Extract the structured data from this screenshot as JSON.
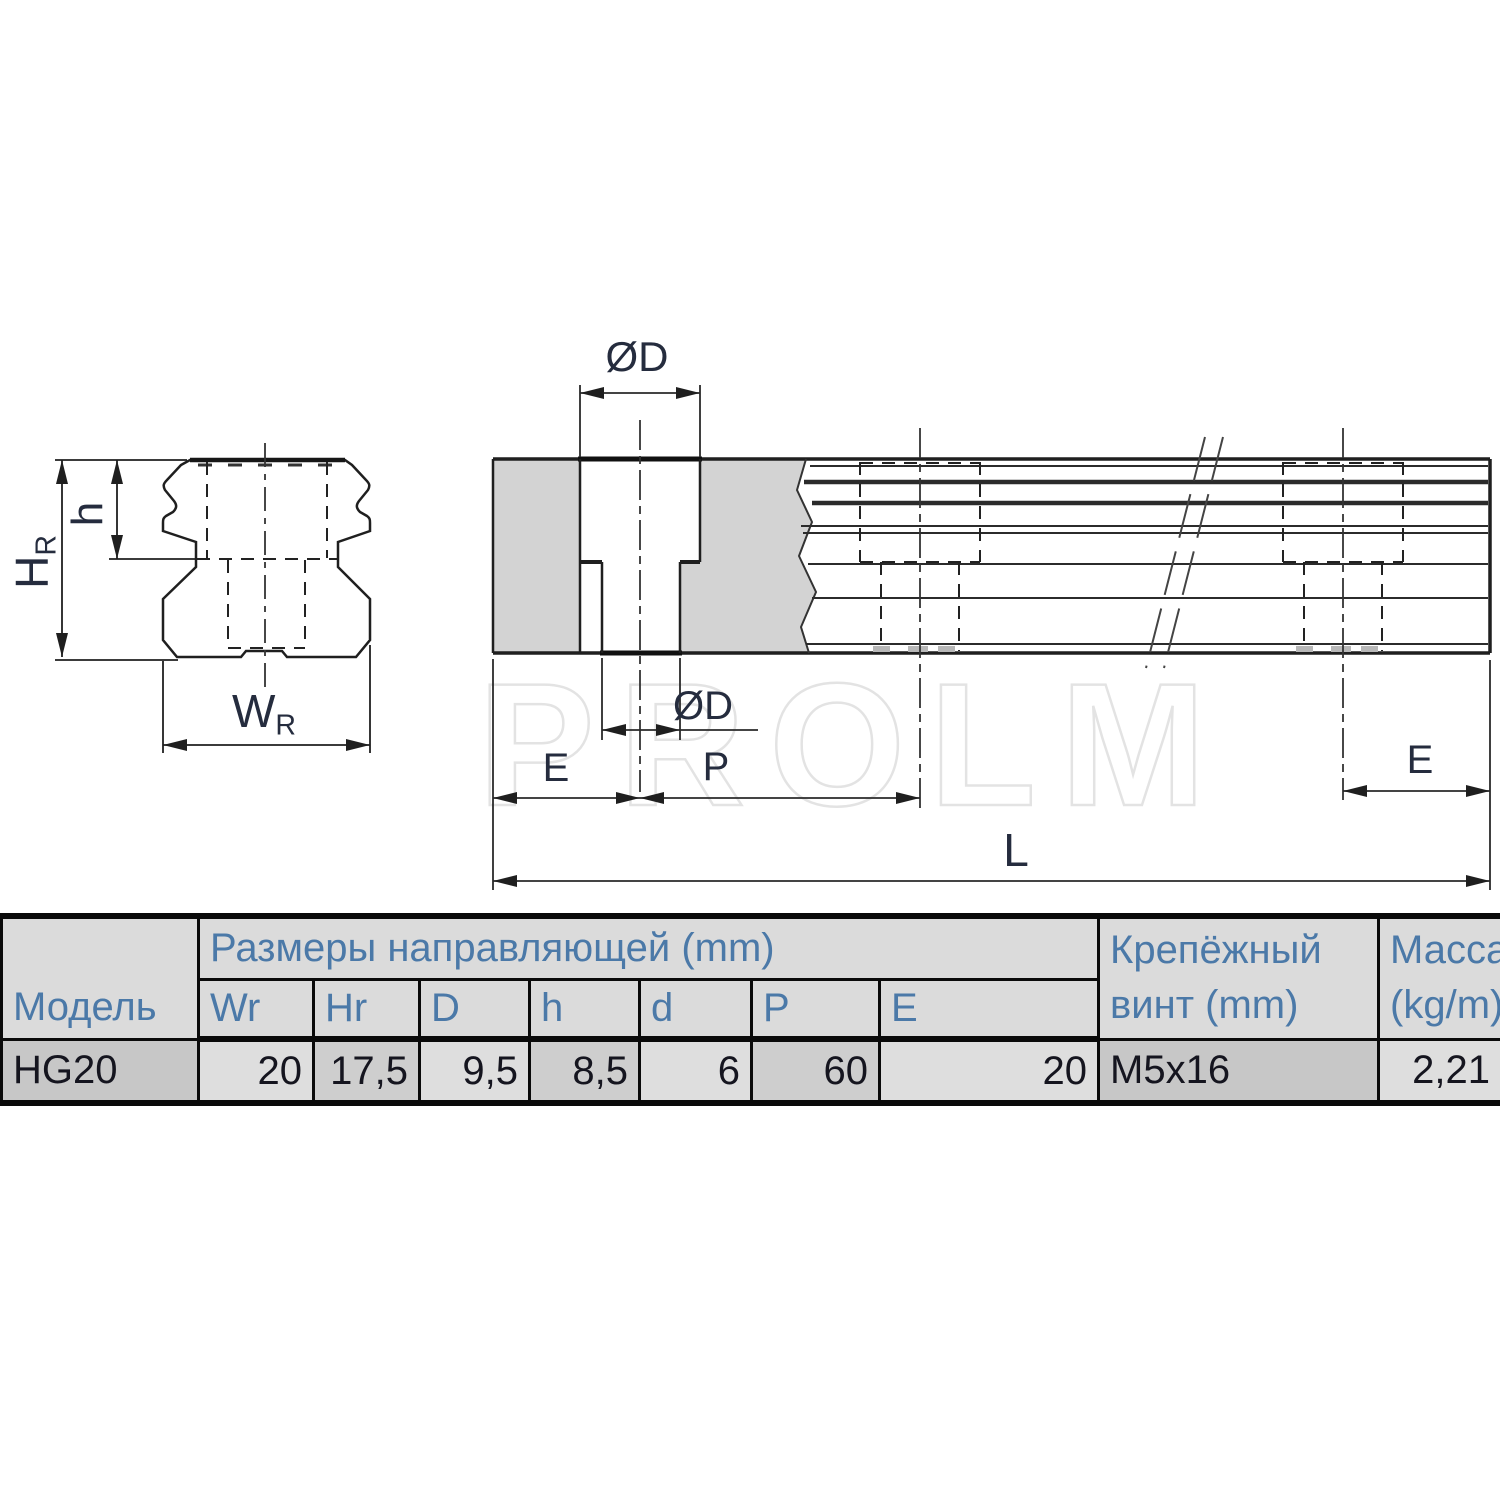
{
  "drawing": {
    "watermark": "PROLM",
    "labels": {
      "od_top": "ØD",
      "od_hole": "ØD",
      "e_left": "E",
      "pitch": "P",
      "length": "L",
      "e_right": "E",
      "rail_height_main": "H",
      "rail_height_sub": "R",
      "counterbore_depth": "h",
      "rail_width_main": "W",
      "rail_width_sub": "R"
    }
  },
  "table": {
    "model_header": "Модель",
    "group_header": "Размеры направляющей (mm)",
    "dim_columns": [
      "Wr",
      "Hr",
      "D",
      "h",
      "d",
      "P",
      "E"
    ],
    "screw_header_line1": "Крепёжный",
    "screw_header_line2": "винт (mm)",
    "mass_header_line1": "Масса",
    "mass_header_line2": "(kg/m)",
    "row": {
      "model": "HG20",
      "dims": [
        "20",
        "17,5",
        "9,5",
        "8,5",
        "6",
        "60",
        "20"
      ],
      "screw": "M5x16",
      "mass": "2,21"
    }
  },
  "colors": {
    "section_fill": "#d3d3d3",
    "line": "#1f1f1f",
    "header_text": "#4b79a8",
    "data_text": "#15151f",
    "watermark_outline": "#e3e3e3"
  }
}
